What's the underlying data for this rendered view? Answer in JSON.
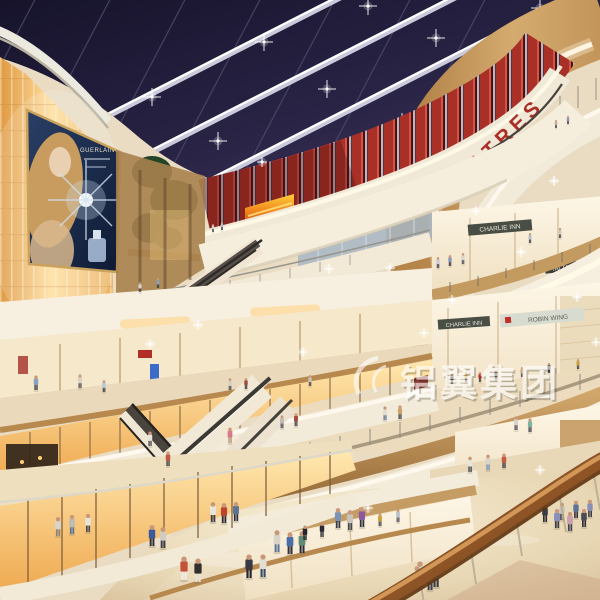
{
  "scene": {
    "description": "Multi-level shopping mall atrium interior (architectural rendering), dusk skylight, curved balconies, escalators, shoppers",
    "theatres_sign": "THEATRES",
    "watermark_text": "铝翼集团",
    "billboard": {
      "brand": "GUERLAIN"
    },
    "stores": {
      "charlie_inn_upper": "CHARLIE INN",
      "charlie_inn_lower": "CHARLIE INN",
      "robin_wing": "ROBIN WING",
      "tai_tai_right_top": "TAI TAI",
      "tai_tai_right_bottom": "TAI TAI",
      "tai_tai_center": "TAI TAI"
    },
    "colors": {
      "sky": "#1a1730",
      "sky_light": "#453c66",
      "beam": "#d8dbe8",
      "wood": "#c9a05f",
      "wood_dark": "#8a5f33",
      "white_band": "#f5eedd",
      "glow_line": "#fff8e4",
      "amber_wall": "#ffdf9e",
      "amber_deep": "#e09a43",
      "red_slat": "#a93027",
      "theatres_red": "#aa2f27",
      "floor": "#f2e7cc",
      "floor_edge": "#d9bfa0",
      "handrail": "#8e5426",
      "led_fire": "#e05a10"
    },
    "ceiling_stars": [
      [
        50,
        152
      ],
      [
        152,
        97
      ],
      [
        264,
        42
      ],
      [
        368,
        6
      ],
      [
        108,
        192
      ],
      [
        218,
        141
      ],
      [
        327,
        89
      ],
      [
        436,
        38
      ],
      [
        540,
        8
      ],
      [
        298,
        176
      ],
      [
        402,
        122
      ],
      [
        502,
        71
      ],
      [
        182,
        206
      ],
      [
        80,
        120
      ],
      [
        575,
        42
      ]
    ],
    "sparkles": [
      [
        390,
        268
      ],
      [
        521,
        252
      ],
      [
        577,
        297
      ],
      [
        424,
        333
      ],
      [
        329,
        269
      ],
      [
        303,
        352
      ],
      [
        150,
        344
      ],
      [
        476,
        211
      ],
      [
        554,
        181
      ],
      [
        262,
        162
      ],
      [
        596,
        342
      ],
      [
        540,
        470
      ],
      [
        368,
        508
      ],
      [
        198,
        325
      ],
      [
        452,
        300
      ]
    ],
    "people": [
      [
        213,
        522,
        22,
        "#e8e4dc",
        "#3c3a42"
      ],
      [
        224,
        523,
        22,
        "#b9452f",
        "#2e2c34"
      ],
      [
        236,
        521,
        21,
        "#5a7296",
        "#30303a"
      ],
      [
        184,
        580,
        26,
        "#c4523a",
        "#f0ece2"
      ],
      [
        198,
        582,
        26,
        "#32302e",
        "#e8e2d6"
      ],
      [
        249,
        578,
        26,
        "#3a3a44",
        "#26262e"
      ],
      [
        263,
        577,
        25,
        "#e2ded4",
        "#3a4a6a"
      ],
      [
        277,
        552,
        24,
        "#d8d4ca",
        "#5a7296"
      ],
      [
        290,
        554,
        24,
        "#4a6ea8",
        "#32323c"
      ],
      [
        302,
        553,
        24,
        "#5f8a74",
        "#2c2c34"
      ],
      [
        338,
        528,
        22,
        "#7a93b8",
        "#3a3a44"
      ],
      [
        350,
        530,
        22,
        "#c9c4ba",
        "#4a4a54"
      ],
      [
        362,
        527,
        22,
        "#8a5a9c",
        "#32323c"
      ],
      [
        420,
        585,
        26,
        "#d8d4cc",
        "#5a7296"
      ],
      [
        436,
        587,
        26,
        "#88b8a8",
        "#3c3c46"
      ],
      [
        557,
        528,
        21,
        "#8890b8",
        "#383842"
      ],
      [
        570,
        531,
        21,
        "#caa0b0",
        "#42424c"
      ],
      [
        584,
        527,
        20,
        "#4a4a54",
        "#2e2e36"
      ],
      [
        152,
        546,
        23,
        "#3a5a9c",
        "#2c2c34"
      ],
      [
        163,
        548,
        23,
        "#d0ccc2",
        "#3a3a44"
      ],
      [
        58,
        536,
        21,
        "#d8d4ca",
        "#8a8478"
      ],
      [
        72,
        534,
        21,
        "#c0bcb2",
        "#5a7296"
      ],
      [
        88,
        532,
        20,
        "#e8e4da",
        "#4a4a54"
      ],
      [
        104,
        392,
        13,
        "#b8c8d8",
        "#3a3a44"
      ],
      [
        230,
        390,
        13,
        "#d8d0c4",
        "#4a4a54"
      ],
      [
        246,
        389,
        12,
        "#9c4a3a",
        "#32323c"
      ],
      [
        310,
        386,
        12,
        "#c8c4ba",
        "#3c3c46"
      ],
      [
        36,
        390,
        16,
        "#88a0c0",
        "#3c3c46"
      ],
      [
        80,
        388,
        15,
        "#d8d4ca",
        "#4a4a54"
      ],
      [
        488,
        470,
        17,
        "#d8d4cc",
        "#7a93b8"
      ],
      [
        504,
        468,
        16,
        "#c75a42",
        "#3a3a44"
      ],
      [
        470,
        472,
        17,
        "#e8e4dc",
        "#4a4a54"
      ],
      [
        545,
        522,
        20,
        "#3c3c44",
        "#2a2a32"
      ],
      [
        576,
        518,
        19,
        "#5a7296",
        "#32323c"
      ],
      [
        590,
        517,
        19,
        "#8890b8",
        "#3c3c46"
      ],
      [
        562,
        520,
        19,
        "#c8c4bc",
        "#4a4a54"
      ],
      [
        282,
        428,
        14,
        "#c0bcb4",
        "#4a4a54"
      ],
      [
        296,
        426,
        14,
        "#a84a3a",
        "#3a3a44"
      ],
      [
        385,
        420,
        15,
        "#e0dcd2",
        "#5a7296"
      ],
      [
        400,
        419,
        15,
        "#caa56a",
        "#3c3c46"
      ],
      [
        516,
        430,
        15,
        "#d8d4cc",
        "#4a4a54"
      ],
      [
        530,
        432,
        15,
        "#7fb3a0",
        "#3c3c46"
      ],
      [
        438,
        268,
        12,
        "#c8ccd8",
        "#3a3a44"
      ],
      [
        450,
        266,
        12,
        "#8898b8",
        "#32323c"
      ],
      [
        463,
        264,
        12,
        "#d8d4ca",
        "#4a4a54"
      ],
      [
        530,
        243,
        11,
        "#b8c0d0",
        "#3c3c46"
      ],
      [
        560,
        238,
        11,
        "#d0ccc4",
        "#42424c"
      ],
      [
        213,
        232,
        9,
        "#d8d4cc",
        "#3a3a44"
      ],
      [
        222,
        230,
        9,
        "#b8bcc8",
        "#32323c"
      ],
      [
        556,
        128,
        9,
        "#c8a8a0",
        "#3a3a44"
      ],
      [
        568,
        124,
        9,
        "#9098a8",
        "#32323c"
      ],
      [
        150,
        446,
        16,
        "#e8e4da",
        "#4a4a54"
      ],
      [
        168,
        466,
        16,
        "#c05a48",
        "#3c3c46"
      ],
      [
        230,
        443,
        17,
        "#d87a8a",
        "#b89878"
      ],
      [
        140,
        292,
        11,
        "#d8d4ca",
        "#4a4a54"
      ],
      [
        158,
        288,
        11,
        "#8aa0b8",
        "#3c3c46"
      ],
      [
        305,
        540,
        16,
        "#26242e",
        "#26242e"
      ],
      [
        322,
        537,
        16,
        "#2c2a34",
        "#2c2a34"
      ],
      [
        380,
        526,
        14,
        "#caa23a",
        "#3c3c46"
      ],
      [
        398,
        522,
        14,
        "#b8c4d0",
        "#4a4a54"
      ],
      [
        452,
        384,
        11,
        "#2e2c34",
        "#2e2c34"
      ],
      [
        466,
        382,
        11,
        "#caa23a",
        "#3a3a44"
      ],
      [
        480,
        382,
        11,
        "#b23028",
        "#3a3a44"
      ],
      [
        496,
        380,
        11,
        "#3a3a44",
        "#3a3a44"
      ],
      [
        522,
        377,
        11,
        "#caa88a",
        "#42424c"
      ],
      [
        549,
        373,
        11,
        "#2c2c36",
        "#2c2c36"
      ],
      [
        578,
        369,
        11,
        "#caa23a",
        "#3c3c46"
      ],
      [
        417,
        588,
        24,
        "#e8e4da",
        "#6a82a0"
      ],
      [
        430,
        590,
        24,
        "#9cb8a8",
        "#3c3c46"
      ]
    ]
  }
}
